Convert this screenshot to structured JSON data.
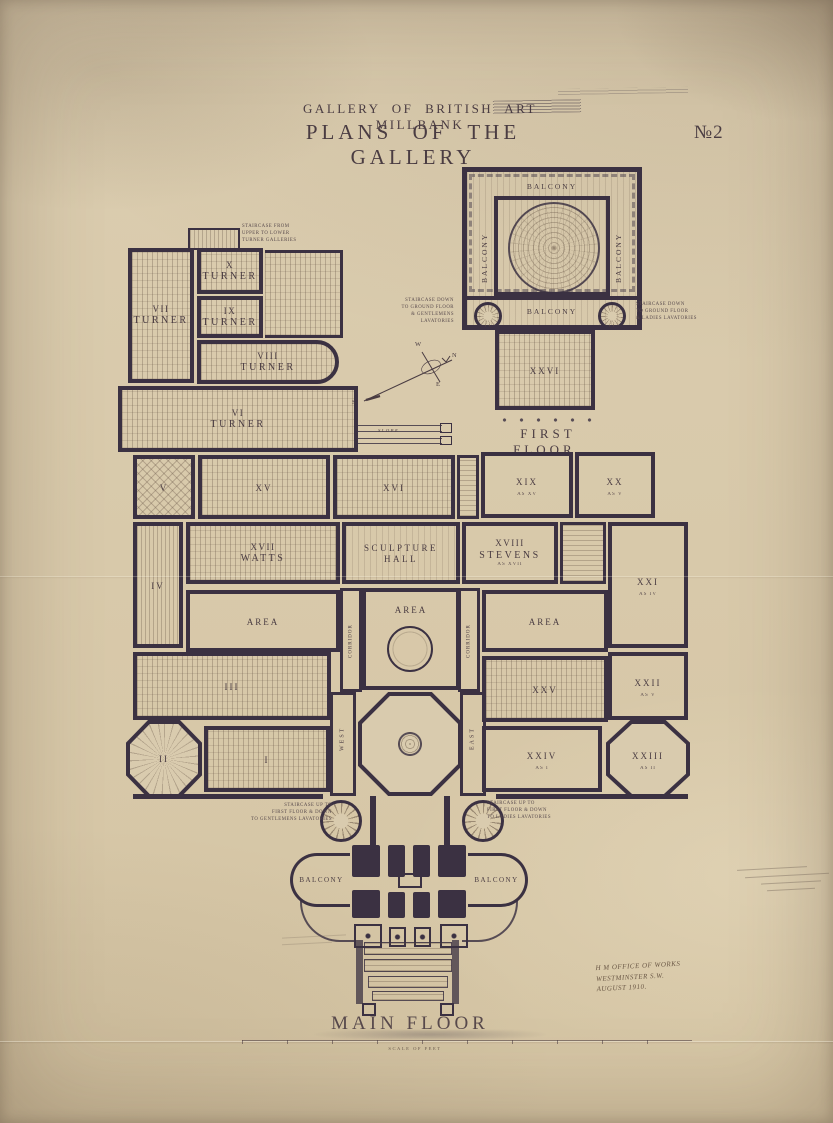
{
  "title": {
    "gallery_line": "GALLERY OF BRITISH ART MILLBANK",
    "plans_line": "PLANS OF THE GALLERY",
    "sheet_number": "№2"
  },
  "first_floor": {
    "caption": "FIRST FLOOR.",
    "balconies": {
      "top": "BALCONY",
      "left": "BALCONY",
      "right": "BALCONY",
      "bottom": "BALCONY"
    },
    "room_xxvi": "XXVI",
    "note_left": "STAIRCASE DOWN\nTO GROUND FLOOR\n& GENTLEMENS\nLAVATORIES",
    "note_right": "STAIRCASE DOWN\nTO GROUND FLOOR\n& LADIES LAVATORIES"
  },
  "notes": {
    "turner_stair": "STAIRCASE FROM\nUPPER TO LOWER\nTURNER GALLERIES",
    "slope": "SLOPE",
    "stair_left": "STAIRCASE UP TO\nFIRST FLOOR & DOWN\nTO GENTLEMENS LAVATORIES",
    "stair_right": "STAIRCASE UP TO\nFIRST FLOOR & DOWN\nTO LADIES LAVATORIES"
  },
  "compass": {
    "n": "N",
    "e": "E",
    "s": "S",
    "w": "W"
  },
  "rooms": {
    "x": {
      "num": "X",
      "name": "TURNER"
    },
    "ix": {
      "num": "IX",
      "name": "TURNER"
    },
    "vii": {
      "num": "VII",
      "name": "TURNER"
    },
    "viii": {
      "num": "VIII",
      "name": "TURNER"
    },
    "vi": {
      "num": "VI",
      "name": "TURNER"
    },
    "v": {
      "num": "V"
    },
    "xv": {
      "num": "XV"
    },
    "xvi": {
      "num": "XVI"
    },
    "xix": {
      "num": "XIX",
      "sub": "AS XV"
    },
    "xx": {
      "num": "XX",
      "sub": "AS V"
    },
    "iv": {
      "num": "IV"
    },
    "xvii": {
      "num": "XVII",
      "name": "WATTS"
    },
    "sculpture_hall": {
      "name": "SCULPTURE HALL"
    },
    "xviii": {
      "num": "XVIII",
      "name": "STEVENS",
      "sub": "AS XVII"
    },
    "xxi": {
      "num": "XXI",
      "sub": "AS IV"
    },
    "area_west": "AREA",
    "area_centre": "AREA",
    "area_east": "AREA",
    "corridor_west": "CORRIDOR",
    "corridor_east": "CORRIDOR",
    "iii": {
      "num": "III"
    },
    "west": "WEST",
    "east": "EAST",
    "xxv": {
      "num": "XXV"
    },
    "xxii": {
      "num": "XXII",
      "sub": "AS V"
    },
    "ii": {
      "num": "II"
    },
    "i": {
      "num": "I"
    },
    "xxiv": {
      "num": "XXIV",
      "sub": "AS I"
    },
    "xxiii": {
      "num": "XXIII",
      "sub": "AS II"
    },
    "balcony_left": "BALCONY",
    "balcony_right": "BALCONY"
  },
  "captions": {
    "main_floor": "MAIN FLOOR",
    "scale": "SCALE OF FEET"
  },
  "stamp": {
    "line1": "H M OFFICE OF WORKS",
    "line2": "WESTMINSTER S.W.",
    "line3": "AUGUST 1910."
  },
  "colors": {
    "ink": "#3b3142",
    "paper": "#d9cbae"
  }
}
